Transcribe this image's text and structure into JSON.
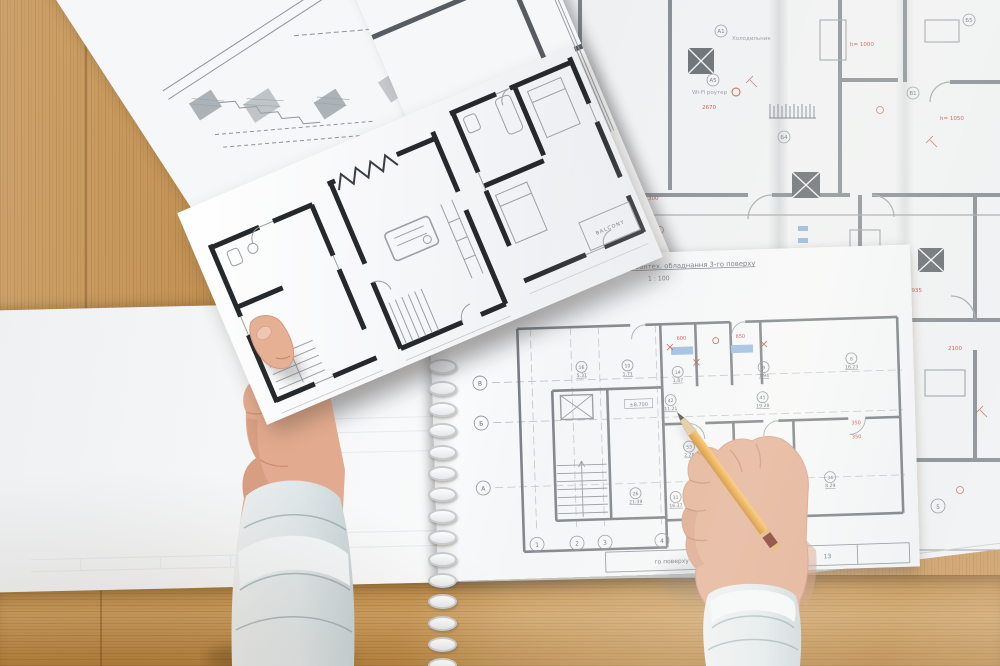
{
  "palette": {
    "wood": "#c69553",
    "paper": "#f6f7f8",
    "blueprint_line": "#7d848a",
    "dark_wall": "#26292c",
    "red_annotation": "#c04737",
    "pencil_body": "#eaa43c",
    "pencil_band": "#79291d",
    "cuff": "#e4eaec",
    "skin": "#e2ab8f"
  },
  "notebook": {
    "title": "План розташування сантех. обладнання 3-го поверху",
    "scale": "1 : 100",
    "elevation": "±8.700",
    "axis_rows": [
      "В",
      "Б",
      "А"
    ],
    "axis_cols": [
      "1",
      "2",
      "3",
      "4"
    ],
    "rooms": [
      {
        "id": "16",
        "area": "5.31"
      },
      {
        "id": "10",
        "area": "1.71"
      },
      {
        "id": "14",
        "area": "1.87"
      },
      {
        "id": "9",
        "area": "7.94"
      },
      {
        "id": "8",
        "area": "16.23"
      },
      {
        "id": "26",
        "area": "21.39"
      },
      {
        "id": "31",
        "area": "16.37"
      },
      {
        "id": "53",
        "area": "2.28"
      },
      {
        "id": "54",
        "area": "2.18"
      },
      {
        "id": "34",
        "area": "8.29"
      },
      {
        "id": "42",
        "area": "11.21"
      },
      {
        "id": "41",
        "area": "19.28"
      }
    ],
    "title_block": {
      "label": "го поверху",
      "page": "13"
    }
  },
  "blueprint": {
    "labels": {
      "wifi": "Wi-Fi роутер",
      "wifi_dim": "2670",
      "fridge": "Холодильник"
    },
    "red_dims": [
      "h= 900",
      "h= 1800",
      "h= 1050",
      "h= 1000",
      "300",
      "200",
      "750",
      "900",
      "2935",
      "2100"
    ],
    "tags": [
      "А1",
      "А5",
      "Б4",
      "В1",
      "Б5"
    ],
    "footer": {
      "title_fragment": "вання електрообладнання 5-го по",
      "axis_tag": "5"
    }
  },
  "held_sheet": {
    "balcony": "BALCONY"
  }
}
